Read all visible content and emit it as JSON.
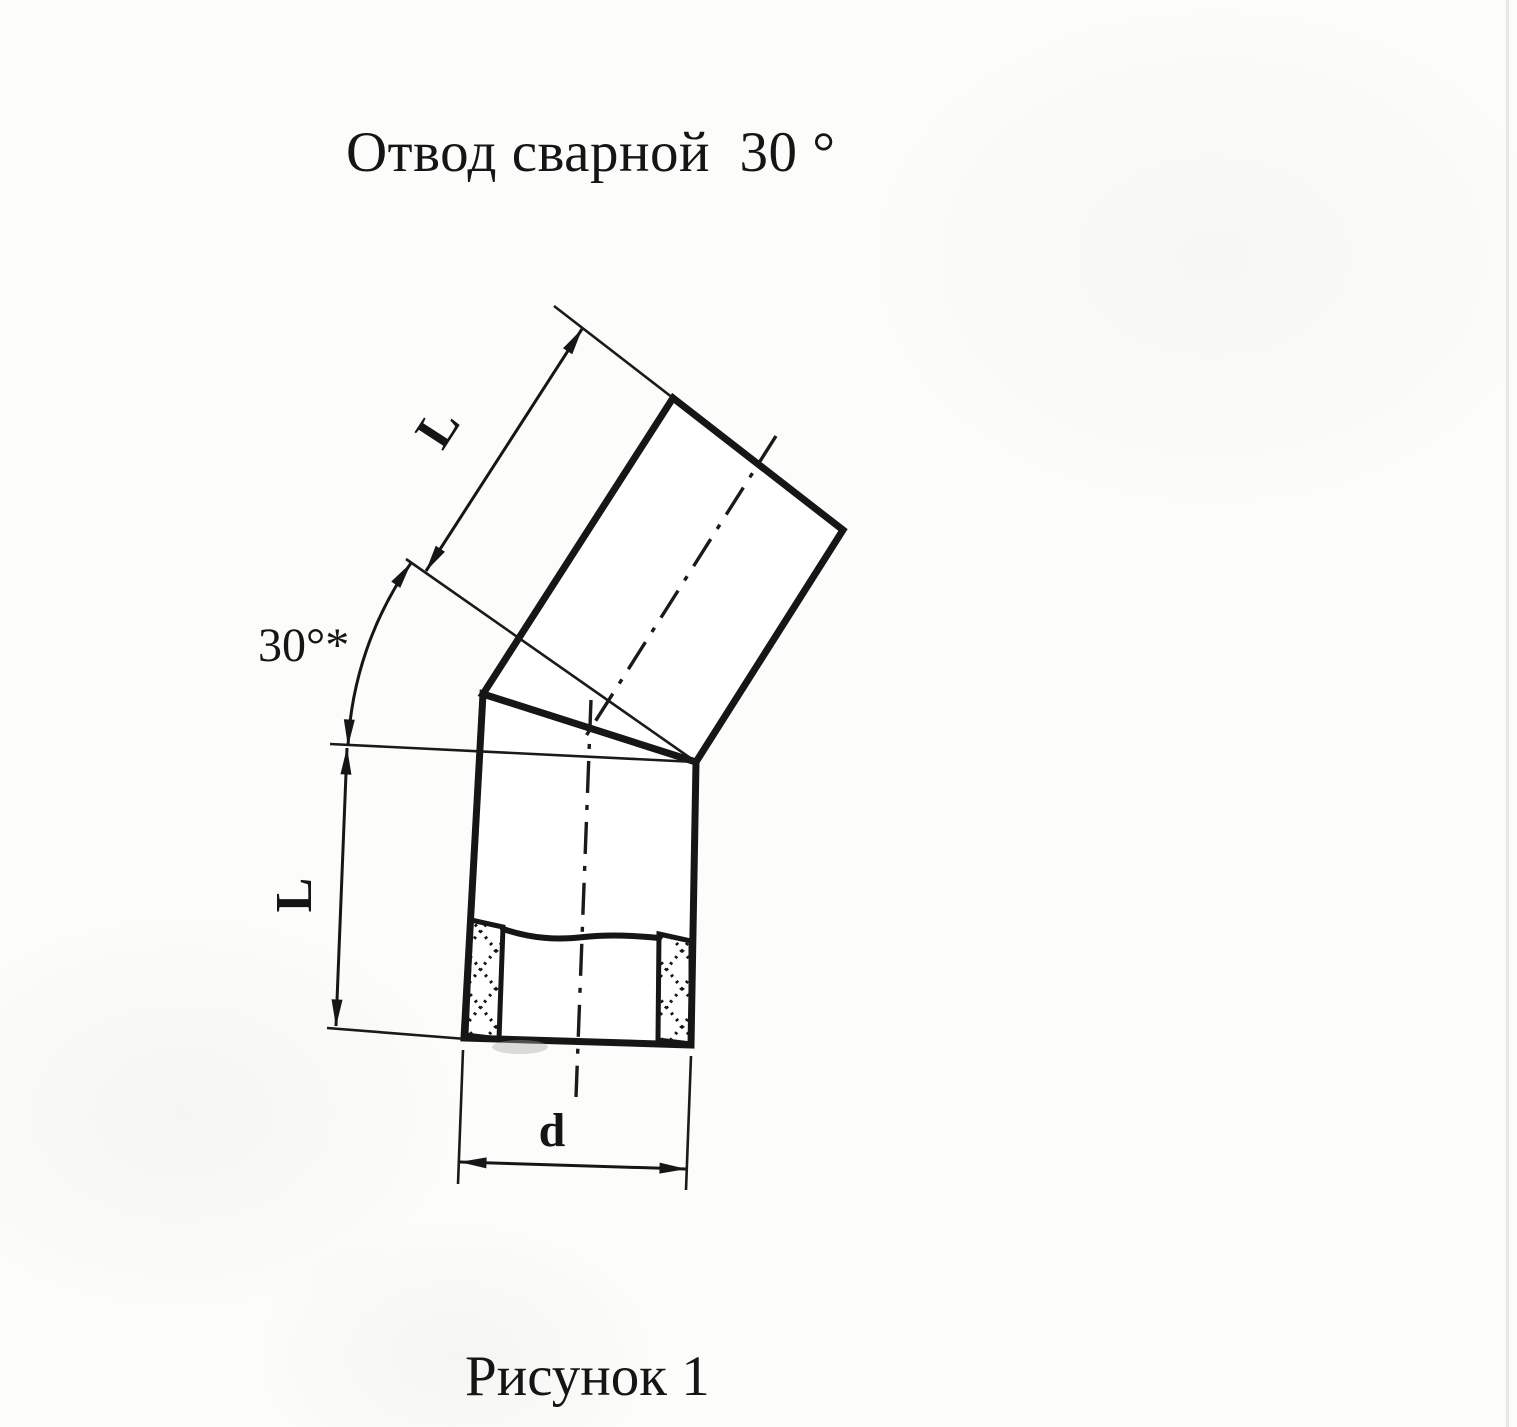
{
  "title": "Отвод сварной  30 °",
  "caption": "Рисунок 1",
  "labels": {
    "upper_length": "L",
    "lower_length": "L",
    "angle": "30°*",
    "diameter": "d"
  },
  "colors": {
    "ink": "#161616",
    "paper": "#fcfcfa"
  }
}
